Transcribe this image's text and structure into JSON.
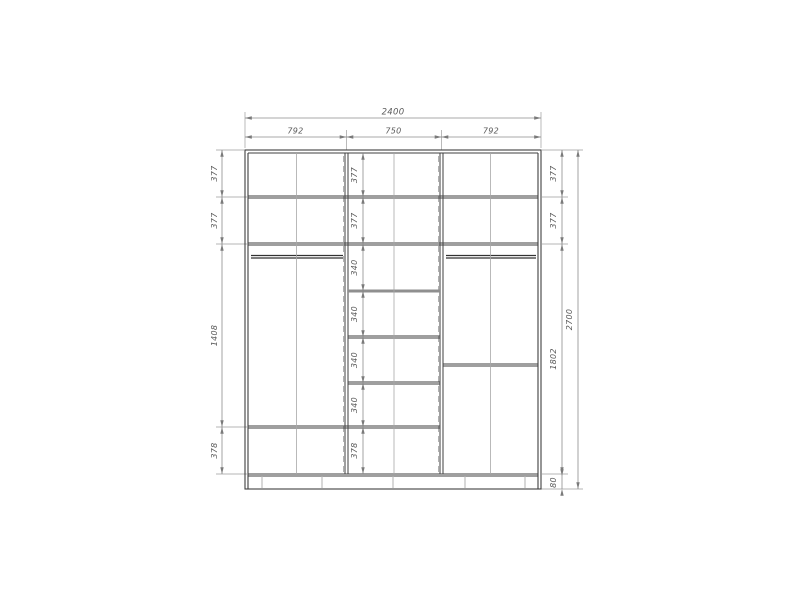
{
  "dims": {
    "overall_width": "2400",
    "sections": [
      "792",
      "750",
      "792"
    ],
    "left_column": [
      "377",
      "377",
      "1408",
      "378"
    ],
    "middle_column": [
      "377",
      "377",
      "340",
      "340",
      "340",
      "340",
      "378"
    ],
    "right_column": [
      "377",
      "377",
      "1802",
      "80"
    ],
    "overall_height": "2700"
  },
  "colors": {
    "structure_line": "#3f3f3f",
    "rod_line": "#333333",
    "gray_shelf": "#8f8f8f",
    "dimension_line": "#8c8c8c",
    "extension_line": "#9e9e9e",
    "label_text": "#5a5a5a",
    "background": "#ffffff"
  }
}
